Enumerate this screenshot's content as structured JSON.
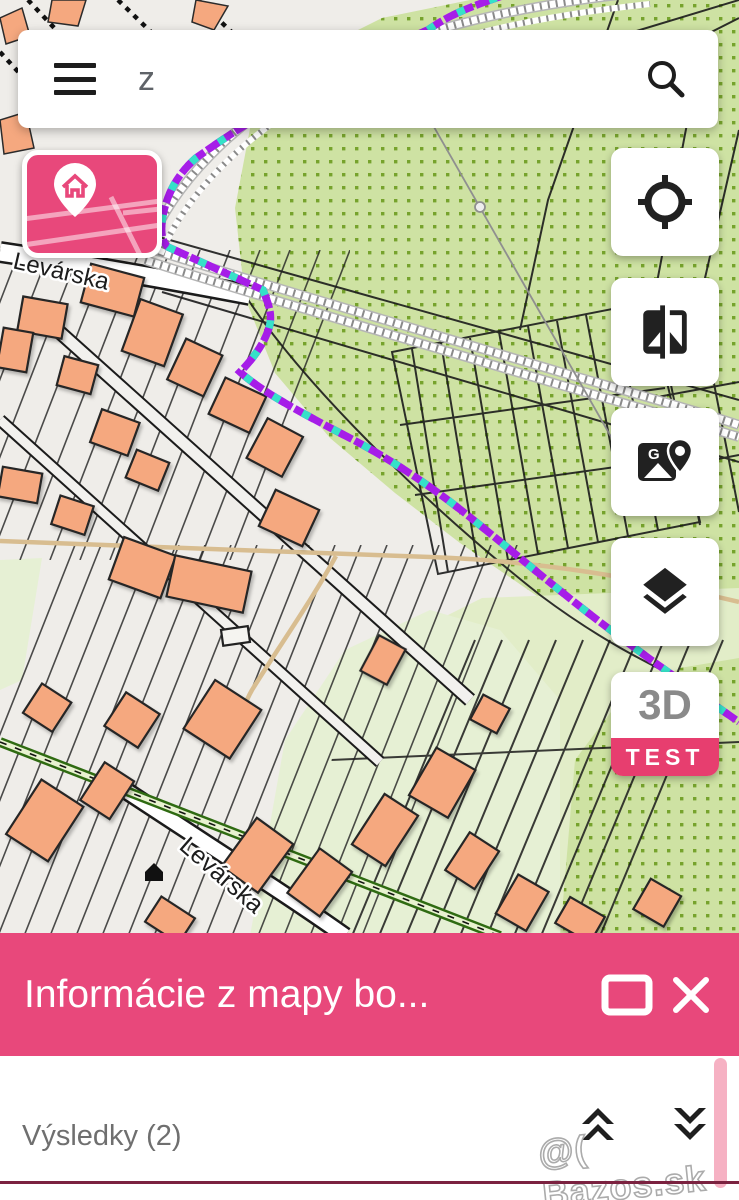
{
  "search": {
    "value": "z"
  },
  "map": {
    "street_labels": [
      "Levárska",
      "Levárska"
    ],
    "colors": {
      "background": "#EFEDE9",
      "orchard_green": "#CEE2A3",
      "orchard_dots": "#76A32C",
      "meadow_green": "#E2EDC8",
      "building": "#F5A87F",
      "cadastral_boundary_purple": "#A61DE8",
      "cadastral_boundary_cyan": "#35E2C8",
      "path_tan": "#D8BD90"
    }
  },
  "controls": {
    "locate": "locate-gps",
    "compare": "compare-layers-swipe",
    "google_maps": "open-google-maps",
    "layers": "layer-switcher",
    "mode_3d_label": "3D",
    "mode_3d_badge": "TEST"
  },
  "bottom_sheet": {
    "title": "Informácie z mapy bo...",
    "results_label": "Výsledky (2)"
  },
  "watermark": "@( Bazos.sk",
  "theme": {
    "brand_pink": "#E8487B",
    "badge_pink": "#E73E6F",
    "scrollbar_pink": "#F6B1C3",
    "bottom_rule": "#7B2240"
  }
}
